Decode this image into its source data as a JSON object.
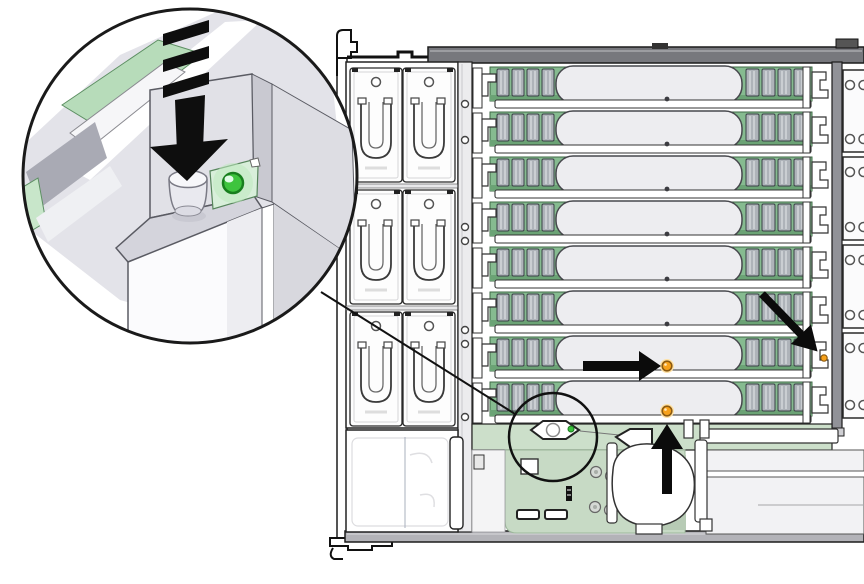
{
  "figure": {
    "type": "hardware-illustration",
    "view": "server-chassis-top",
    "background": "#ffffff"
  },
  "colors": {
    "outline": "#1a1a1a",
    "chassis_bar_gray": "#77787d",
    "bottom_bar_gray": "#b3b3b8",
    "wall_gray": "#919298",
    "cover_gray": "#ededf0",
    "pcb_green": "#86bb90",
    "pcb_green_dark": "#6ba375",
    "board_green": "#c7dac5",
    "strip_green": "#ccdfca",
    "callout_pcb_green": "#b7dcba",
    "dimm_gray": "#aeb3b9",
    "led_green": "#3ec43e",
    "led_green_ring": "#187f1e",
    "led_amber": "#f7a11a",
    "led_amber_ring": "#8c5a10",
    "led_amber_glow": "#ffe2a6",
    "unlit_dot": "#3c3c41",
    "arrow_black": "#0b0b0b"
  },
  "fan_bay": {
    "modules": [
      {
        "row": 1
      },
      {
        "row": 2
      },
      {
        "row": 3
      }
    ],
    "fans_per_module": 2
  },
  "risers": [
    {
      "slot": 1,
      "cover_led": "off",
      "edge_led": "off"
    },
    {
      "slot": 2,
      "cover_led": "off",
      "edge_led": "off"
    },
    {
      "slot": 3,
      "cover_led": "off",
      "edge_led": "off"
    },
    {
      "slot": 4,
      "cover_led": "off",
      "edge_led": "off"
    },
    {
      "slot": 5,
      "cover_led": "off",
      "edge_led": "off"
    },
    {
      "slot": 6,
      "cover_led": "off",
      "edge_led": "off"
    },
    {
      "slot": 7,
      "cover_led": "amber",
      "edge_led": "amber"
    },
    {
      "slot": 8,
      "cover_led": "amber",
      "edge_led": "off"
    }
  ],
  "dimms_per_riser_group": 4,
  "right_panels": [
    {
      "index": 1,
      "holes": 2
    },
    {
      "index": 2,
      "holes": 2
    },
    {
      "index": 3,
      "holes": 2
    },
    {
      "index": 4,
      "holes": 2
    }
  ],
  "callouts": {
    "magnifier": {
      "shows": "riser-release-button",
      "button_state": "pressed",
      "status_led": {
        "color": "green",
        "state": "on"
      }
    },
    "location_ring": {
      "marks": "release-button-location-on-motherboard"
    }
  },
  "arrows": [
    {
      "id": "press-arrow",
      "direction": "down",
      "target": "riser-release-button"
    },
    {
      "id": "arrow-right",
      "direction": "right",
      "target": "riser-7-cover-led"
    },
    {
      "id": "arrow-up",
      "direction": "up",
      "target": "riser-8-cover-led"
    },
    {
      "id": "arrow-diagonal",
      "direction": "down-right",
      "target": "riser-7-edge-led"
    }
  ]
}
